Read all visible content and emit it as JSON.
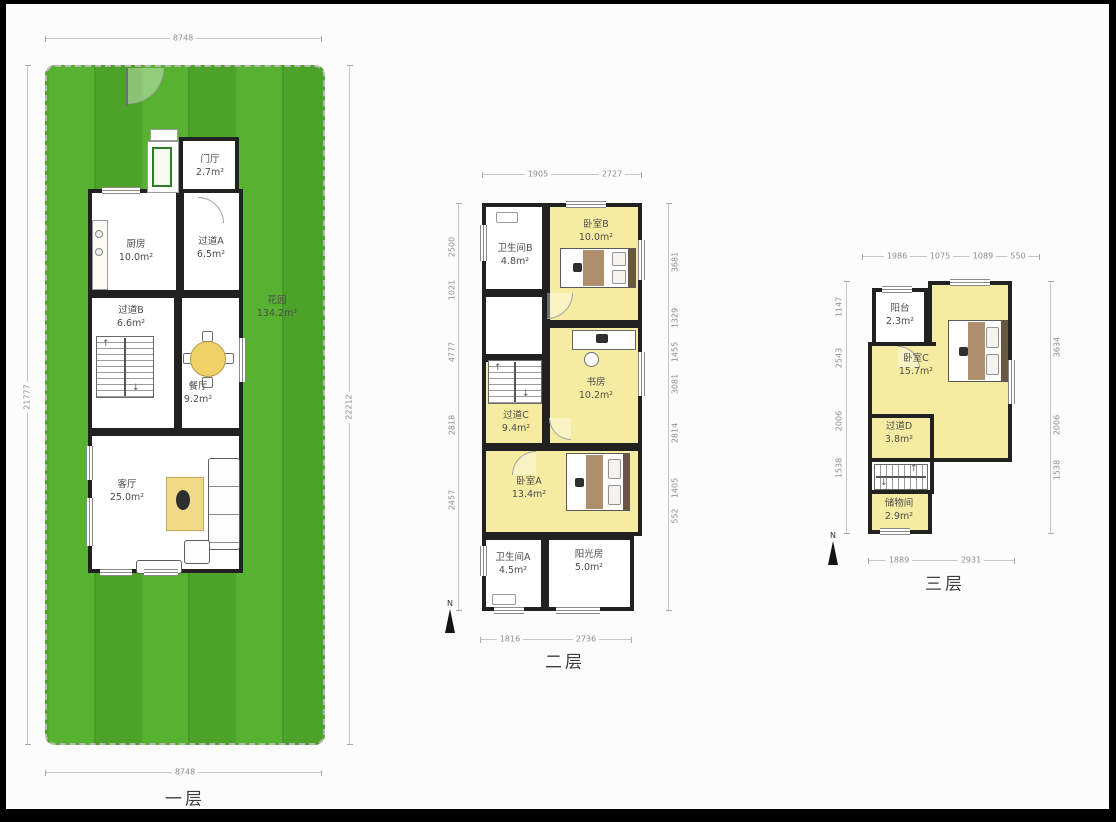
{
  "floor1": {
    "label": "一层",
    "dim_top": "8748",
    "dim_bottom": "8748",
    "dim_left": "21777",
    "dim_right": "22212",
    "rooms": {
      "entry": {
        "name": "门厅",
        "area": "2.7m²"
      },
      "kitchen": {
        "name": "厨房",
        "area": "10.0m²"
      },
      "hall_a": {
        "name": "过道A",
        "area": "6.5m²"
      },
      "hall_b": {
        "name": "过道B",
        "area": "6.6m²"
      },
      "dining": {
        "name": "餐厅",
        "area": "9.2m²"
      },
      "living": {
        "name": "客厅",
        "area": "25.0m²"
      },
      "garden": {
        "name": "花园",
        "area": "134.2m²"
      }
    }
  },
  "floor2": {
    "label": "二层",
    "north": "N",
    "dims_top": [
      "1905",
      "2727"
    ],
    "dims_bottom": [
      "1816",
      "2736"
    ],
    "dims_left": [
      "2500",
      "1021",
      "4777",
      "2818",
      "2457"
    ],
    "dims_right": [
      "3681",
      "1329",
      "1455",
      "3081",
      "2814",
      "1405",
      "552"
    ],
    "rooms": {
      "bath_b": {
        "name": "卫生间B",
        "area": "4.8m²"
      },
      "bed_b": {
        "name": "卧室B",
        "area": "10.0m²"
      },
      "study": {
        "name": "书房",
        "area": "10.2m²"
      },
      "hall_c": {
        "name": "过道C",
        "area": "9.4m²"
      },
      "bed_a": {
        "name": "卧室A",
        "area": "13.4m²"
      },
      "bath_a": {
        "name": "卫生间A",
        "area": "4.5m²"
      },
      "sunroom": {
        "name": "阳光房",
        "area": "5.0m²"
      }
    }
  },
  "floor3": {
    "label": "三层",
    "north": "N",
    "dims_top": [
      "1986",
      "1075",
      "1089",
      "550"
    ],
    "dims_bottom": [
      "1889",
      "2931"
    ],
    "dims_left": [
      "1147",
      "2543",
      "2006",
      "1538"
    ],
    "dims_right": [
      "3634",
      "2006",
      "1538"
    ],
    "rooms": {
      "balcony": {
        "name": "阳台",
        "area": "2.3m²"
      },
      "bed_c": {
        "name": "卧室C",
        "area": "15.7m²"
      },
      "hall_d": {
        "name": "过道D",
        "area": "3.8m²"
      },
      "storage": {
        "name": "储物间",
        "area": "2.9m²"
      }
    }
  }
}
